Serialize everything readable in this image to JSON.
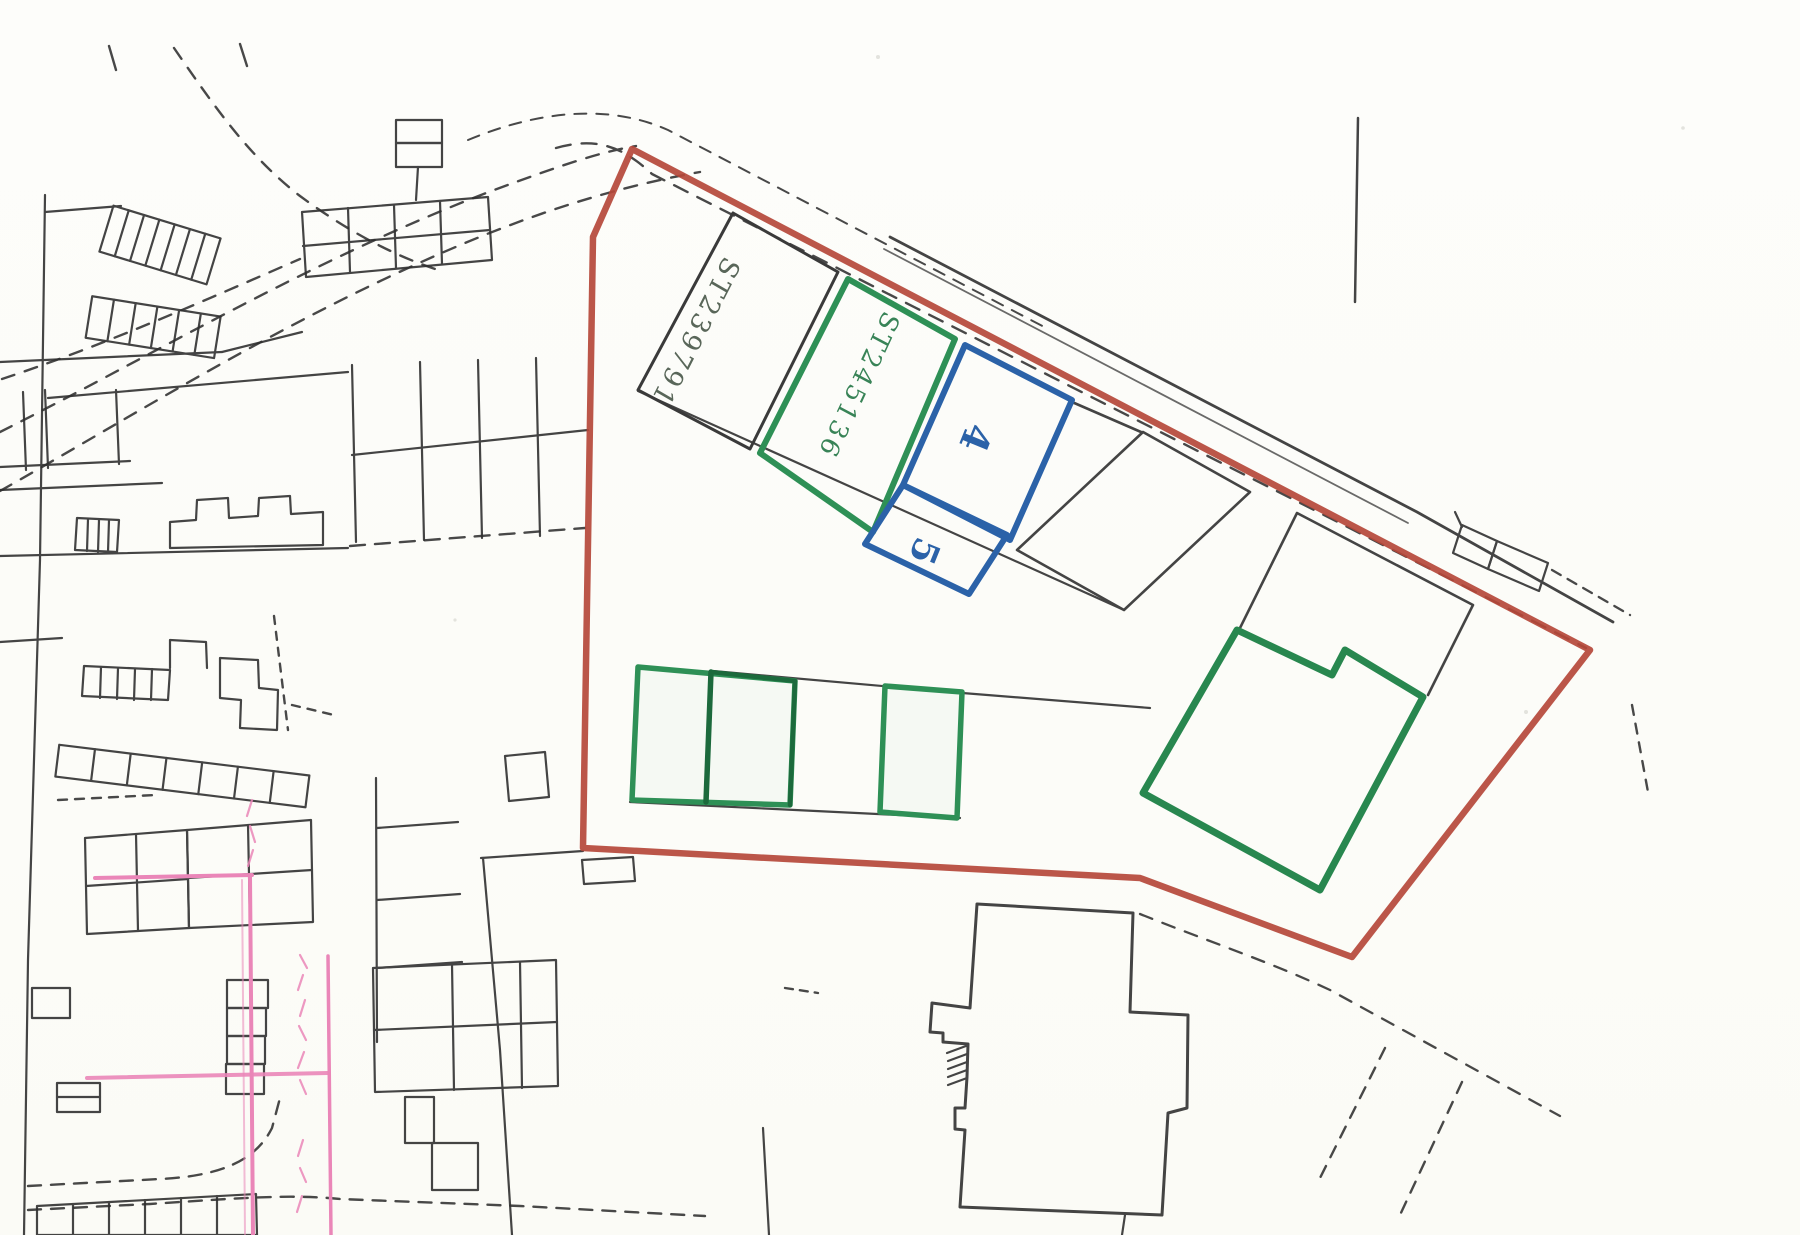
{
  "map": {
    "kind": "scanned cadastral site location plan",
    "plots": [
      {
        "id": "st239791",
        "label": "ST239791",
        "outline_color": "#3a3a3a",
        "label_color": "#4b5a4b"
      },
      {
        "id": "st245136",
        "label": "ST245136",
        "outline_color": "#2e9056",
        "label_color": "#2e7d4e"
      },
      {
        "id": "plot-4",
        "label": "4",
        "outline_color": "#2b62a8",
        "label_color": "#2b62a8"
      },
      {
        "id": "plot-5",
        "label": "5",
        "outline_color": "#2b62a8",
        "label_color": "#2b62a8"
      }
    ],
    "colors": {
      "site_boundary_red": "#b5483a",
      "highlight_green": "#2e9056",
      "highlight_green_dark": "#1c6a3c",
      "highlight_blue": "#2b62a8",
      "linework_black": "#2f2f2f",
      "annotation_pink": "#ea86b8",
      "paper": "#fcfcf9"
    }
  }
}
